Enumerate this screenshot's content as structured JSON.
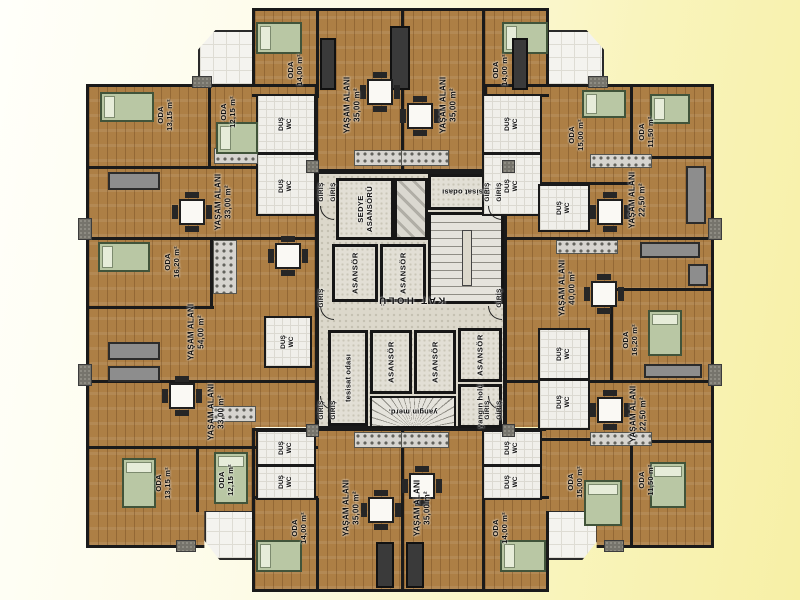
{
  "labels": {
    "yasam_alani": "YAŞAM ALANI",
    "oda": "ODA",
    "giris": "GİRİŞ",
    "dus_wc": "DUŞ WC",
    "asansor": "ASANSÖR",
    "sedye_asansoru": "SEDYE ASANSÖRÜ",
    "kat_holu": "KAT HOLÜ",
    "tesisat_odasi": "tesisat odası",
    "yangin_holu": "yangın holü",
    "yangin_merd": "yangın merd."
  },
  "apartments": {
    "top_center_left": {
      "living_area": "35,00 m²",
      "oda_area": "14,00 m²"
    },
    "top_center_right": {
      "living_area": "35,00 m²",
      "oda_area": "14,00 m²"
    },
    "top_left": {
      "living_area": "33,00 m²",
      "oda1_area": "13,15 m²",
      "oda2_area": "12,15 m²"
    },
    "left_middle": {
      "living_area": "54,00 m²",
      "oda_area": "16,20 m²"
    },
    "bottom_left": {
      "living_area": "33,00 m²",
      "oda1_area": "13,15 m²",
      "oda2_area": "12,15 m²"
    },
    "bottom_center_left": {
      "living_area": "35,00 m²",
      "oda_area": "14,00 m²"
    },
    "bottom_center_right": {
      "living_area": "35,00 m²",
      "oda_area": "14,00 m²"
    },
    "top_right": {
      "living_area": "22,50 m²",
      "oda1_area": "15,00 m²",
      "oda2_area": "11,50 m²"
    },
    "right_middle": {
      "living_area": "40,00 m²",
      "oda_area": "16,20 m²"
    },
    "bottom_right": {
      "living_area": "22,50 m²",
      "oda1_area": "15,00 m²",
      "oda2_area": "11,50 m²"
    }
  },
  "colors": {
    "background_yellow": "#f7f0a6",
    "background_white": "#fffffa",
    "wood_floor": "#ad7f45",
    "core_floor": "#dcd8cb",
    "wall": "#1a1a1a",
    "bathroom_tile": "#f0efea",
    "bed_green": "#b9c7a4"
  }
}
